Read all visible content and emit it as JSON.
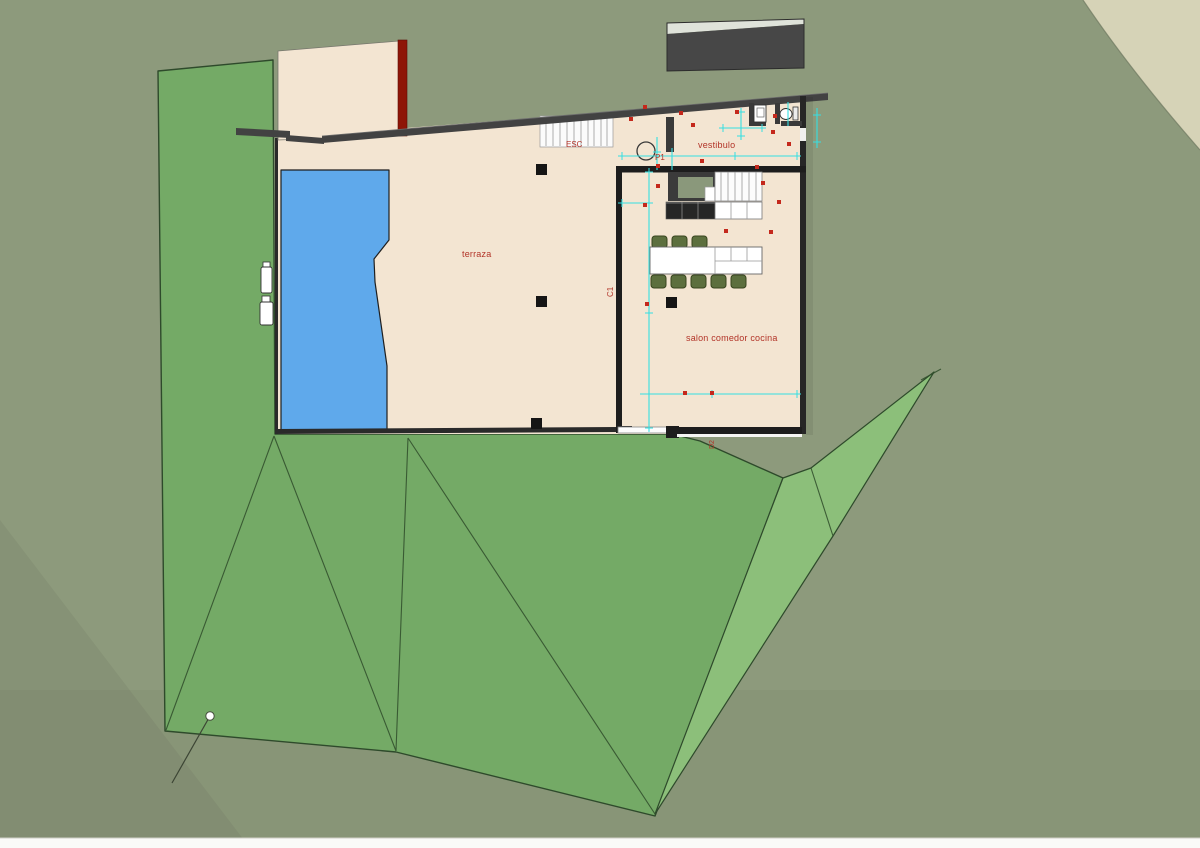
{
  "scene": {
    "description": "3D architectural site plan render of a house with terrace, pool and garden terrain"
  },
  "labels": {
    "terrace": "terraza",
    "vestibule": "vestibulo",
    "living_kitchen": "salon comedor cocina",
    "exterior_stairs": "ESC",
    "door_p1": "P1",
    "section_c1": "C1",
    "door_d2": "D2"
  },
  "colors": {
    "background_olive": "#8d9a7c",
    "page_strip": "#fafaf8",
    "sand_corner": "#d6d3b7",
    "terrain_green": "#74aa66",
    "terrain_green_light": "#8cbf7a",
    "pool_blue": "#5fa9eb",
    "floor_cream": "#f3e5d2",
    "wall_gray": "#424242",
    "wall_dark": "#1d1d1d",
    "roof_dark": "#474747",
    "roof_light": "#dfe3da",
    "wall_accent_red": "#8e1507",
    "annotation_red": "#b23327",
    "marker_red": "#c4281c",
    "dimension_cyan": "#35dfe2",
    "chair_green": "#5c6f3e",
    "fixture_white": "#ffffff"
  }
}
